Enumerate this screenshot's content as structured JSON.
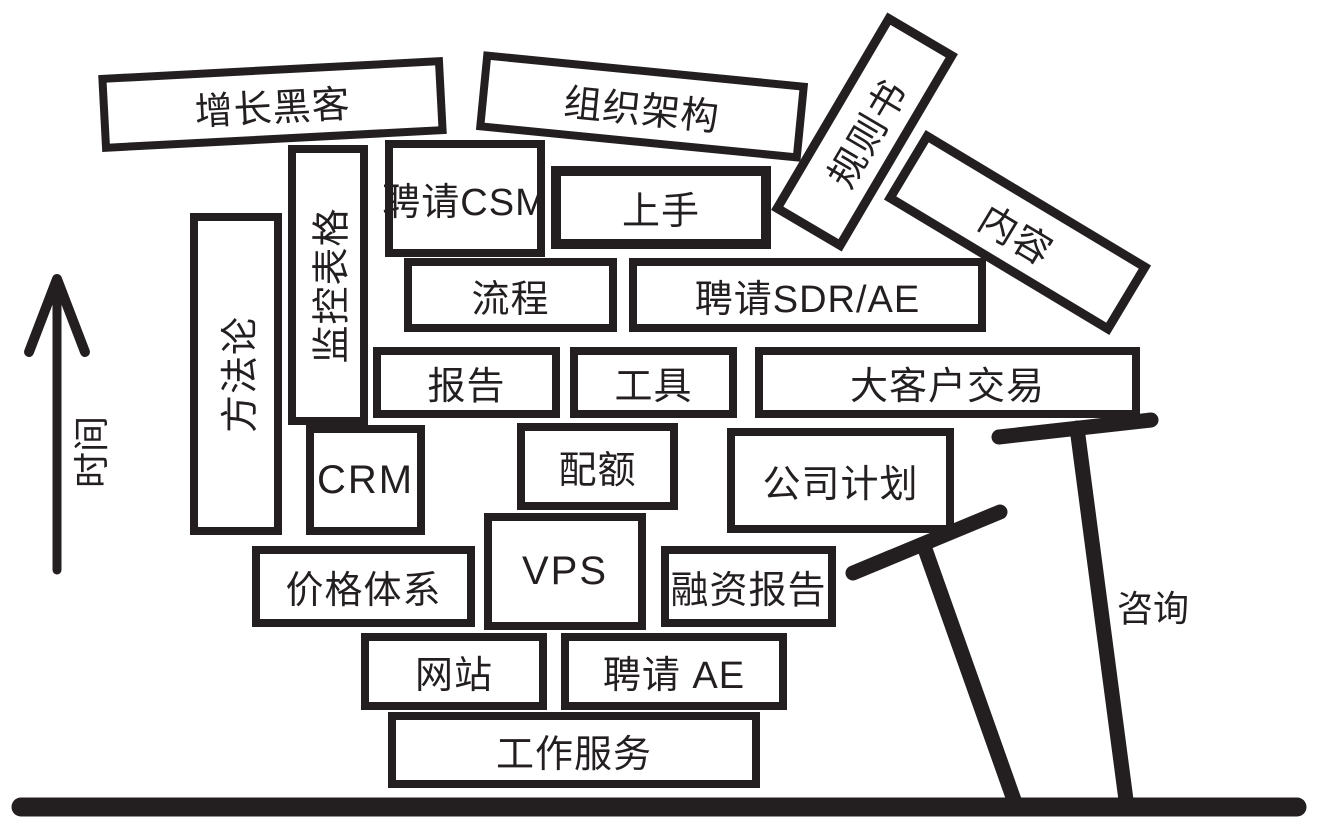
{
  "diagram": {
    "title_semantic": "jenga-tower-of-startup-tasks",
    "colors": {
      "ink": "#231f20",
      "background": "#ffffff"
    },
    "axis": {
      "time_label": "时间",
      "arrow_icon": "up-arrow-icon"
    },
    "supports": {
      "consulting_label": "咨询",
      "crutch_icon": "crutch-prop-icon",
      "ground_icon": "ground-line"
    },
    "blocks": {
      "growth_hacking": "增长黑客",
      "org_structure": "组织架构",
      "rulebook": "规则书",
      "content": "内容",
      "monitoring_sheet": "监控表格",
      "hire_csm": "聘请CSM",
      "onboarding": "上手",
      "process": "流程",
      "hire_sdr_ae": "聘请SDR/AE",
      "methodology": "方法论",
      "reports": "报告",
      "tools": "工具",
      "enterprise_deals": "大客户交易",
      "crm": "CRM",
      "quota": "配额",
      "company_plan": "公司计划",
      "pricing": "价格体系",
      "vps": "VPS",
      "funding_report": "融资报告",
      "website": "网站",
      "hire_ae": "聘请 AE",
      "work_services": "工作服务"
    }
  }
}
